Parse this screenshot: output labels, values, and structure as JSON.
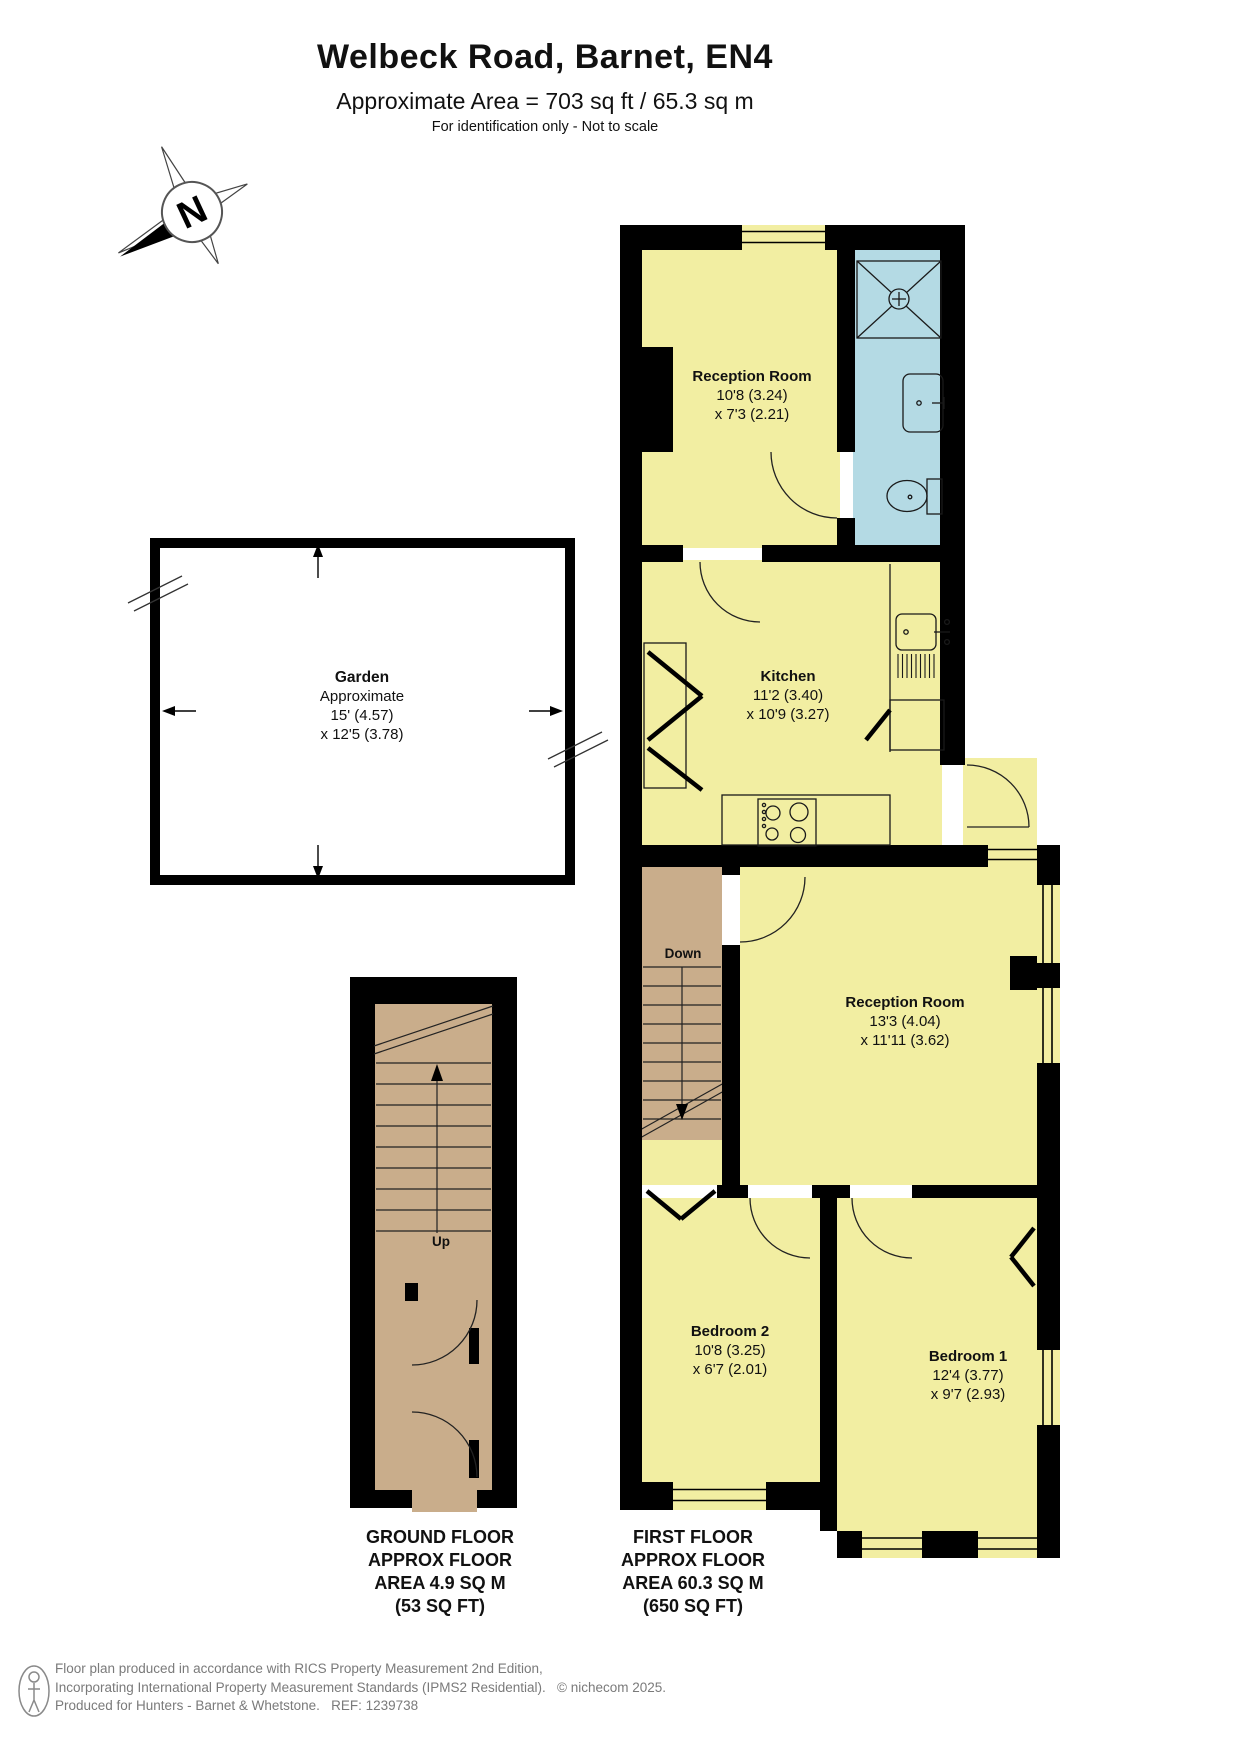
{
  "header": {
    "title": "Welbeck Road, Barnet, EN4",
    "subtitle": "Approximate Area = 703 sq ft / 65.3 sq m",
    "disclaimer": "For identification only - Not to scale"
  },
  "compass": {
    "label": "N"
  },
  "garden": {
    "name": "Garden",
    "approx": "Approximate",
    "dim1": "15' (4.57)",
    "dim2": "x 12'5 (3.78)"
  },
  "rooms": {
    "reception1": {
      "name": "Reception Room",
      "dim1": "10'8 (3.24)",
      "dim2": "x 7'3 (2.21)"
    },
    "kitchen": {
      "name": "Kitchen",
      "dim1": "11'2 (3.40)",
      "dim2": "x 10'9 (3.27)"
    },
    "reception2": {
      "name": "Reception Room",
      "dim1": "13'3 (4.04)",
      "dim2": "x 11'11 (3.62)"
    },
    "bedroom2": {
      "name": "Bedroom 2",
      "dim1": "10'8 (3.25)",
      "dim2": "x 6'7 (2.01)"
    },
    "bedroom1": {
      "name": "Bedroom 1",
      "dim1": "12'4 (3.77)",
      "dim2": "x 9'7 (2.93)"
    }
  },
  "stairs": {
    "down_label": "Down",
    "up_label": "Up"
  },
  "floor_labels": {
    "ground": [
      "GROUND FLOOR",
      "APPROX FLOOR",
      "AREA 4.9 SQ M",
      "(53 SQ FT)"
    ],
    "first": [
      "FIRST FLOOR",
      "APPROX FLOOR",
      "AREA 60.3 SQ M",
      "(650 SQ FT)"
    ]
  },
  "footer": {
    "lines": [
      "Floor plan produced in accordance with RICS Property Measurement 2nd Edition,",
      "Incorporating International Property Measurement Standards (IPMS2 Residential).   © nichecom 2025.",
      "Produced for Hunters - Barnet & Whetstone.   REF: 1239738"
    ]
  },
  "colors": {
    "room_fill": "#F2EEA2",
    "bathroom_fill": "#B4DAE4",
    "stairs_fill": "#C9AD8B",
    "wall": "#000000",
    "footer_text": "#7A7A7A"
  }
}
